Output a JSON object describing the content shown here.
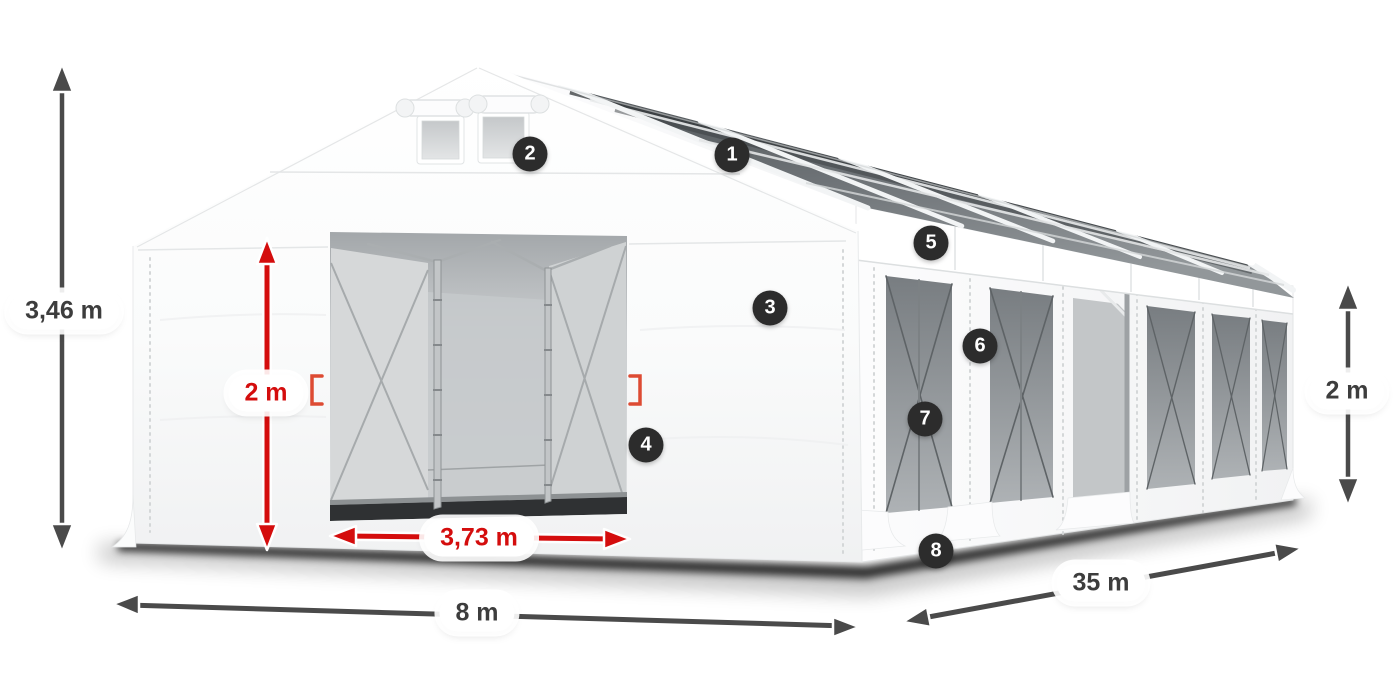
{
  "figure": {
    "type": "product-dimension-diagram",
    "subject": "White storage marquee tent with transparent roof panels, two gable vents, open sliding front entrance and mesh side windows",
    "background_color": "#ffffff",
    "colors": {
      "arrow_dark": "#4a4a4a",
      "arrow_red": "#d40d0d",
      "label_background": "#ffffff",
      "label_text_dark": "#3d3d3d",
      "label_text_red": "#d40d0d",
      "badge_background": "#2c2c2c",
      "badge_text": "#ffffff",
      "tent_fabric": "#ffffff",
      "roof_glazing": "#53585b",
      "window_mesh": "#84898d"
    },
    "dimensions": [
      {
        "id": "total-height",
        "label": "3,46 m",
        "style": "dark",
        "axis": "vertical",
        "location": "far-left"
      },
      {
        "id": "entrance-height",
        "label": "2 m",
        "style": "red",
        "axis": "vertical",
        "location": "front-entrance"
      },
      {
        "id": "entrance-width",
        "label": "3,73 m",
        "style": "red",
        "axis": "horizontal",
        "location": "front-entrance"
      },
      {
        "id": "front-width",
        "label": "8 m",
        "style": "dark",
        "axis": "horizontal",
        "location": "bottom-front"
      },
      {
        "id": "side-length",
        "label": "35 m",
        "style": "dark",
        "axis": "diagonal",
        "location": "bottom-right"
      },
      {
        "id": "side-wall-height",
        "label": "2 m",
        "style": "dark",
        "axis": "vertical",
        "location": "far-right"
      }
    ],
    "hotspots": [
      {
        "number": "1",
        "location": "roof-glazing"
      },
      {
        "number": "2",
        "location": "gable-vent"
      },
      {
        "number": "3",
        "location": "front-wall"
      },
      {
        "number": "4",
        "location": "entrance-edge"
      },
      {
        "number": "5",
        "location": "eave-band"
      },
      {
        "number": "6",
        "location": "side-pillar"
      },
      {
        "number": "7",
        "location": "side-window"
      },
      {
        "number": "8",
        "location": "base-skirt"
      }
    ]
  }
}
